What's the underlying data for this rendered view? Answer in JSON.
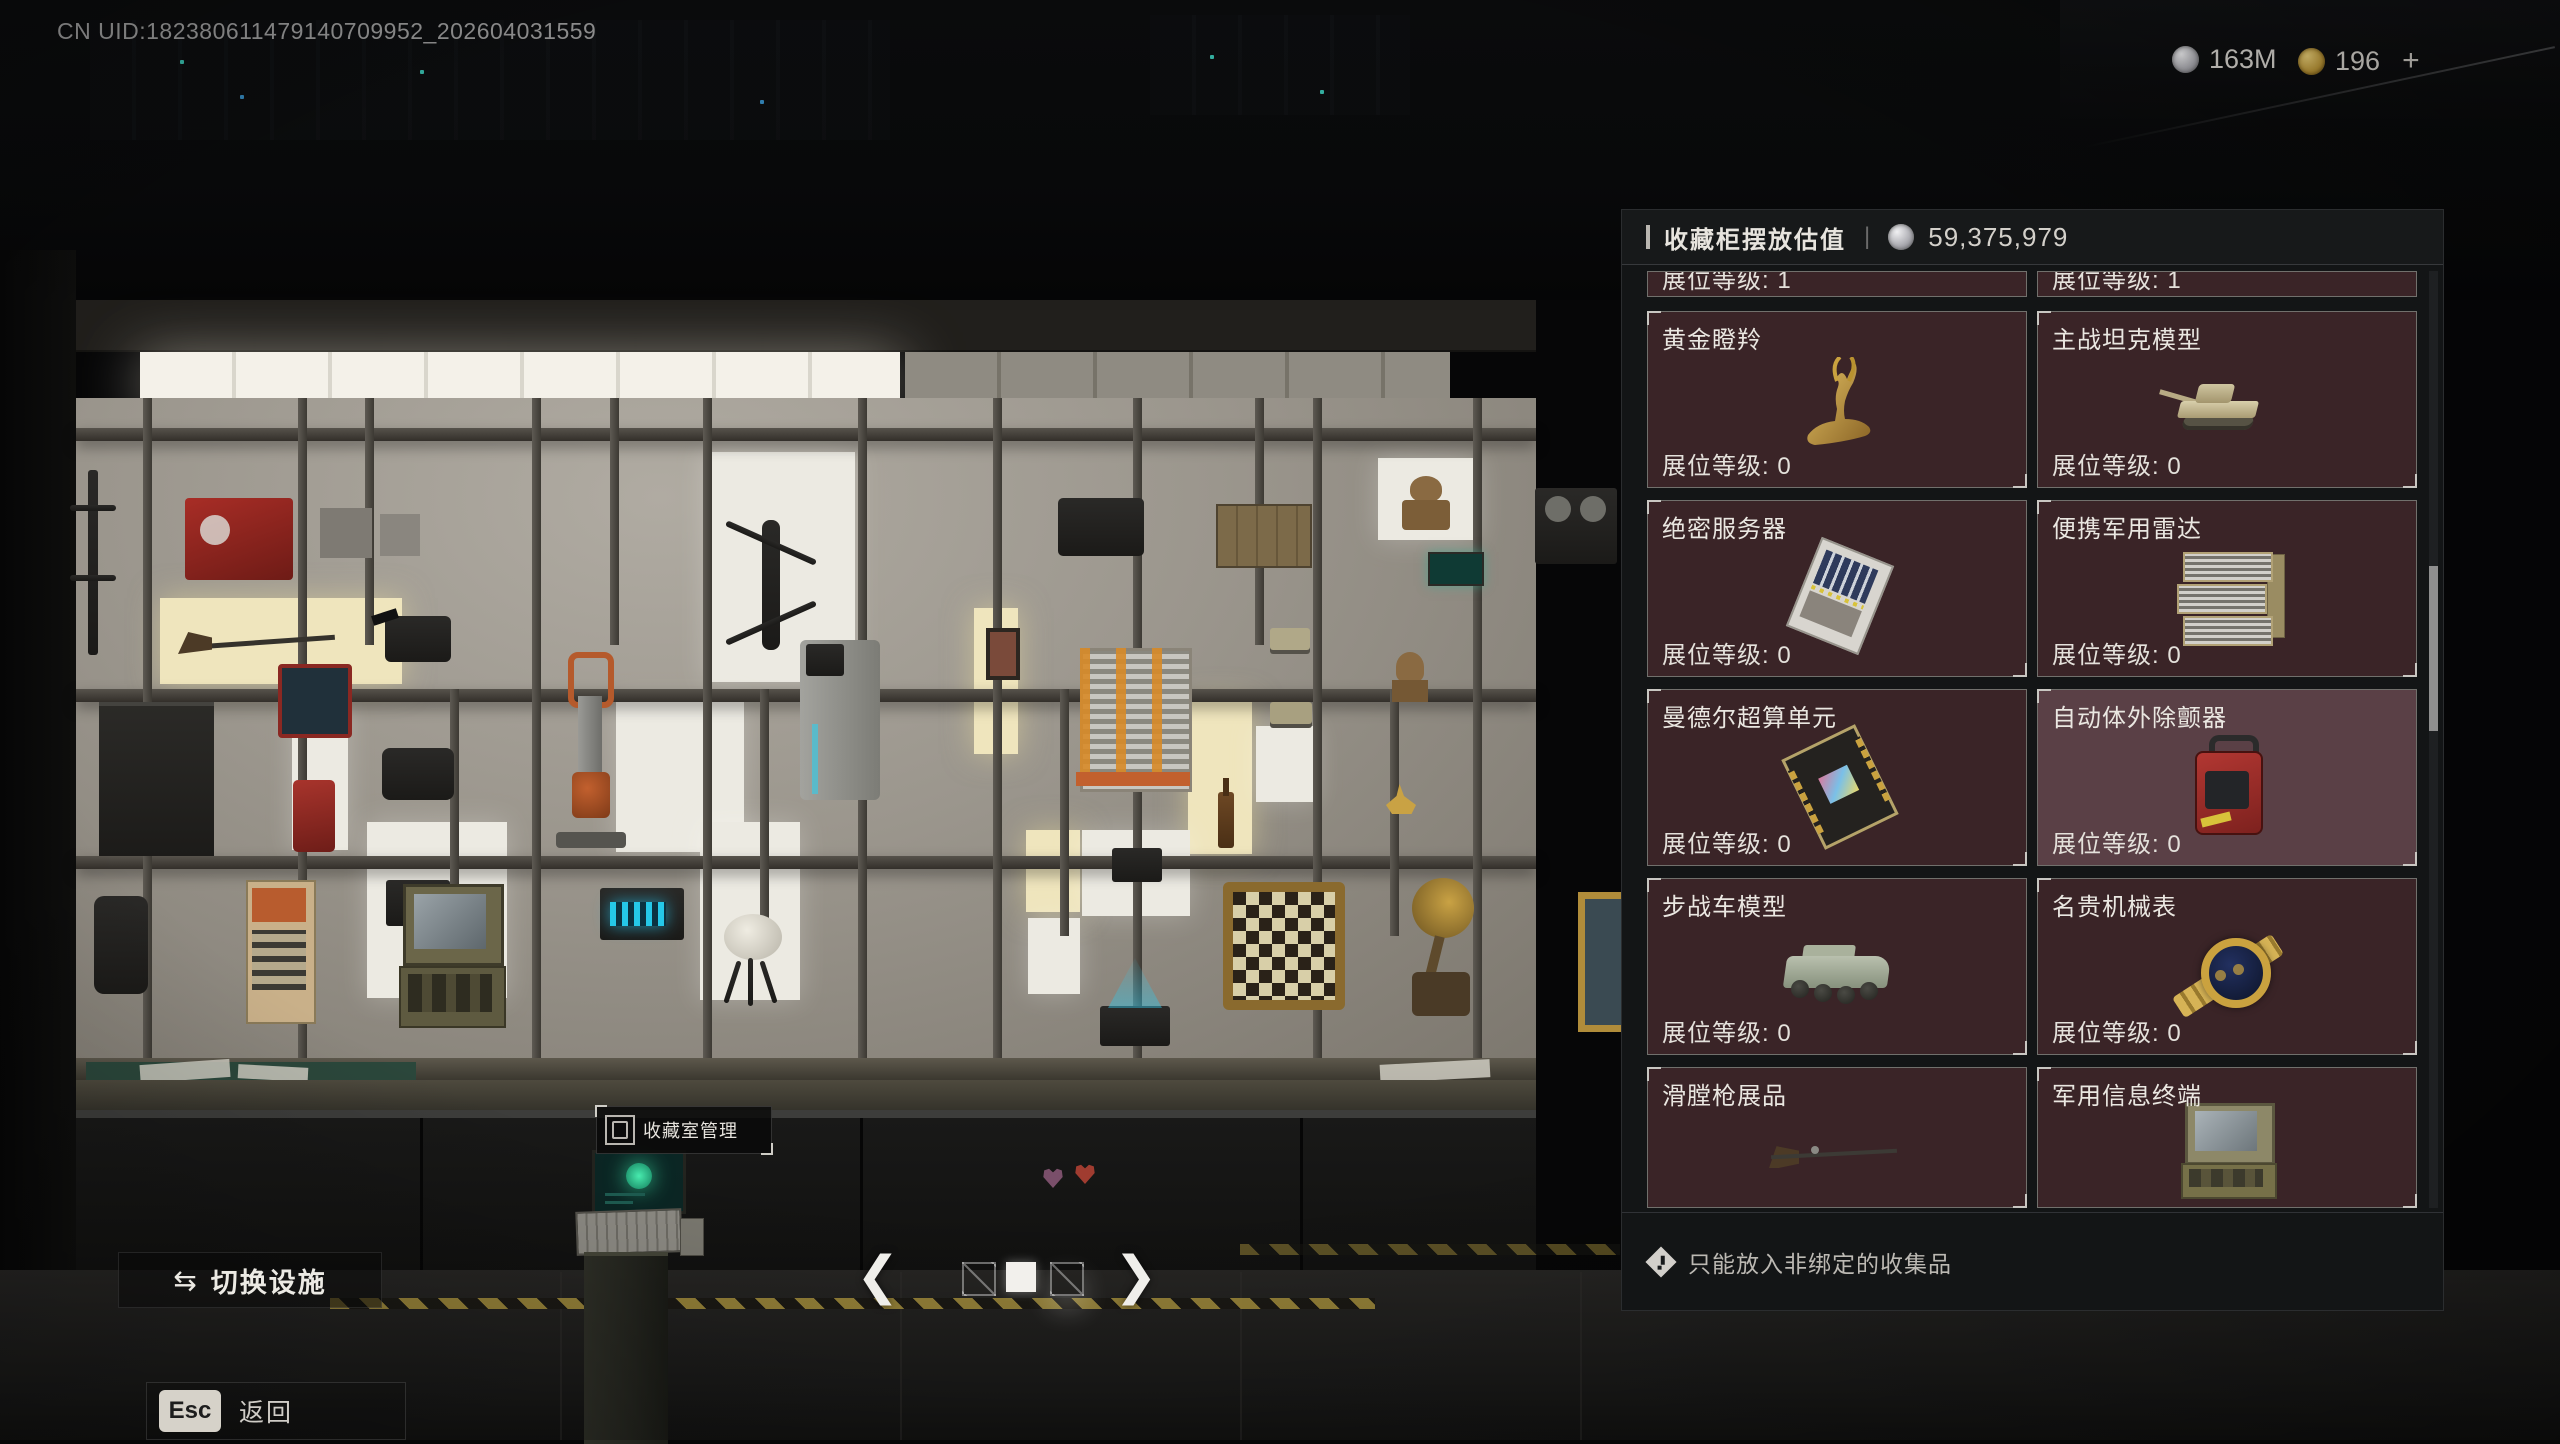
{
  "hud": {
    "uid_text": "CN UID:182380611479140709952_202604031559",
    "currencies": [
      {
        "icon": "silver-coin",
        "value": "163M"
      },
      {
        "icon": "gold-coin",
        "value": "196",
        "suffix": "+"
      }
    ]
  },
  "panel": {
    "title": "收藏柜摆放估值",
    "total_value": "59,375,979",
    "partial_cards": [
      {
        "level_label": "展位等级: 1"
      },
      {
        "level_label": "展位等级: 1"
      }
    ],
    "cards": [
      {
        "name": "黄金瞪羚",
        "level_label": "展位等级: 0",
        "icon": "golden-gazelle"
      },
      {
        "name": "主战坦克模型",
        "level_label": "展位等级: 0",
        "icon": "tank-model"
      },
      {
        "name": "绝密服务器",
        "level_label": "展位等级: 0",
        "icon": "secret-server"
      },
      {
        "name": "便携军用雷达",
        "level_label": "展位等级: 0",
        "icon": "military-radar"
      },
      {
        "name": "曼德尔超算单元",
        "level_label": "展位等级: 0",
        "icon": "compute-unit"
      },
      {
        "name": "自动体外除颤器",
        "level_label": "展位等级: 0",
        "icon": "aed-defibrillator",
        "highlighted": true
      },
      {
        "name": "步战车模型",
        "level_label": "展位等级: 0",
        "icon": "ifv-model"
      },
      {
        "name": "名贵机械表",
        "level_label": "展位等级: 0",
        "icon": "luxury-watch"
      },
      {
        "name": "滑膛枪展品",
        "level_label": "",
        "icon": "musket"
      },
      {
        "name": "军用信息终端",
        "level_label": "",
        "icon": "terminal-case"
      }
    ],
    "footer_note": "只能放入非绑定的收集品"
  },
  "scene": {
    "terminal_label": "收藏室管理"
  },
  "controls": {
    "switch_facility": "切换设施",
    "swap_glyph": "⇆",
    "esc_key": "Esc",
    "back_label": "返回",
    "chevron_left": "❮",
    "chevron_right": "❯"
  },
  "colors": {
    "card_bg": "#3a2427",
    "card_highlight": "#5a4046",
    "accent_gold": "#caa23f",
    "panel_bg": "#131516"
  }
}
